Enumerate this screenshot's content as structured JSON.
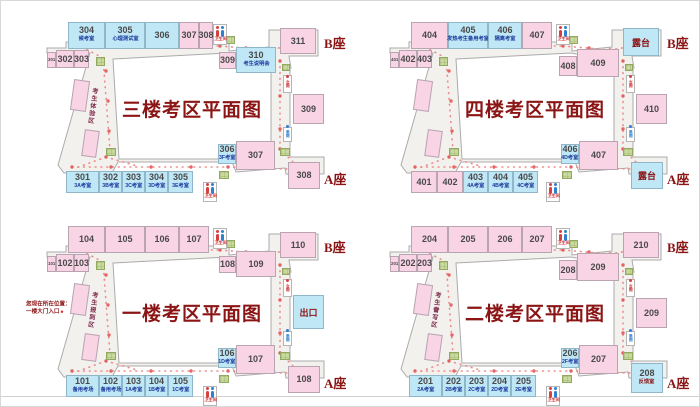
{
  "labels": {
    "building_b": "B座",
    "building_a": "A座",
    "restroom": "卫生间",
    "wc_female": "女厕",
    "wc_male": "男厕"
  },
  "colors": {
    "title": "#8B1414",
    "pink_room": "#F8D4E4",
    "blue_room": "#BFE7F6",
    "path_dots": "#ED8C8C",
    "stairs_green": "#C9DA9F",
    "sublabel_navy": "#1B3A9E"
  },
  "floors": [
    {
      "id": "floor-3",
      "title": "三楼考区平面图",
      "corridor_text": "考生体验区",
      "offset": [
        5,
        0
      ],
      "rooms": [
        {
          "n": "304",
          "sub": "候考室",
          "t": "blue",
          "x": 62,
          "y": 21,
          "w": 37,
          "h": 27
        },
        {
          "n": "305",
          "sub": "心理测试室",
          "t": "blue",
          "x": 99,
          "y": 21,
          "w": 40,
          "h": 27
        },
        {
          "n": "306",
          "t": "blue",
          "x": 139,
          "y": 21,
          "w": 34,
          "h": 27
        },
        {
          "n": "307",
          "t": "pink",
          "x": 173,
          "y": 21,
          "w": 20,
          "h": 27
        },
        {
          "n": "308",
          "t": "pink",
          "x": 193,
          "y": 21,
          "w": 14,
          "h": 27
        },
        {
          "n": "301",
          "t": "tiny",
          "x": 41,
          "y": 51,
          "w": 9,
          "h": 16
        },
        {
          "n": "302",
          "t": "pink",
          "x": 50,
          "y": 49,
          "w": 18,
          "h": 18
        },
        {
          "n": "303",
          "t": "pink",
          "x": 68,
          "y": 49,
          "w": 15,
          "h": 18
        },
        {
          "t": "diag",
          "x": 66,
          "y": 79,
          "w": 16,
          "h": 31
        },
        {
          "t": "diag",
          "x": 77,
          "y": 129,
          "w": 15,
          "h": 27
        },
        {
          "n": "309",
          "t": "pink",
          "x": 213,
          "y": 51,
          "w": 17,
          "h": 17
        },
        {
          "n": "310",
          "sub": "考生说明会",
          "t": "blue",
          "x": 230,
          "y": 46,
          "w": 40,
          "h": 26
        },
        {
          "n": "311",
          "t": "pink",
          "x": 274,
          "y": 27,
          "w": 36,
          "h": 26
        },
        {
          "n": "309",
          "t": "pink",
          "x": 287,
          "y": 93,
          "w": 31,
          "h": 30
        },
        {
          "n": "306",
          "sub": "3F考室",
          "t": "blue",
          "x": 212,
          "y": 143,
          "w": 18,
          "h": 20
        },
        {
          "n": "307",
          "t": "pink",
          "x": 230,
          "y": 140,
          "w": 39,
          "h": 29
        },
        {
          "n": "308",
          "t": "pink",
          "x": 282,
          "y": 161,
          "w": 32,
          "h": 27
        },
        {
          "n": "301",
          "sub": "3A考室",
          "t": "blue",
          "x": 60,
          "y": 170,
          "w": 33,
          "h": 22
        },
        {
          "n": "302",
          "sub": "3B考室",
          "t": "blue",
          "x": 93,
          "y": 170,
          "w": 23,
          "h": 22
        },
        {
          "n": "303",
          "sub": "3C考室",
          "t": "blue",
          "x": 116,
          "y": 170,
          "w": 23,
          "h": 22
        },
        {
          "n": "304",
          "sub": "3D考室",
          "t": "blue",
          "x": 139,
          "y": 170,
          "w": 23,
          "h": 22
        },
        {
          "n": "305",
          "sub": "3E考室",
          "t": "blue",
          "x": 162,
          "y": 170,
          "w": 25,
          "h": 22
        }
      ]
    },
    {
      "id": "floor-4",
      "title": "四楼考区平面图",
      "corridor_text": "",
      "offset": [
        348,
        0
      ],
      "rooms": [
        {
          "n": "404",
          "t": "pink",
          "x": 62,
          "y": 21,
          "w": 37,
          "h": 27
        },
        {
          "n": "405",
          "sub": "发热考生备用考室",
          "t": "blue",
          "x": 99,
          "y": 21,
          "w": 40,
          "h": 27
        },
        {
          "n": "406",
          "sub": "隔离考室",
          "t": "blue",
          "x": 139,
          "y": 21,
          "w": 34,
          "h": 27
        },
        {
          "n": "407",
          "t": "pink",
          "x": 173,
          "y": 21,
          "w": 30,
          "h": 27
        },
        {
          "n": "401",
          "t": "tiny",
          "x": 41,
          "y": 51,
          "w": 9,
          "h": 16
        },
        {
          "n": "402",
          "t": "pink",
          "x": 50,
          "y": 49,
          "w": 18,
          "h": 18
        },
        {
          "n": "403",
          "t": "pink",
          "x": 68,
          "y": 49,
          "w": 15,
          "h": 18
        },
        {
          "t": "diag",
          "x": 66,
          "y": 79,
          "w": 16,
          "h": 31
        },
        {
          "t": "diag",
          "x": 77,
          "y": 129,
          "w": 15,
          "h": 27
        },
        {
          "n": "408",
          "t": "pink",
          "x": 210,
          "y": 55,
          "w": 18,
          "h": 20
        },
        {
          "n": "409",
          "t": "pink",
          "x": 228,
          "y": 48,
          "w": 42,
          "h": 28
        },
        {
          "lab": "露台",
          "t": "terrace",
          "x": 274,
          "y": 27,
          "w": 36,
          "h": 28
        },
        {
          "n": "410",
          "t": "pink",
          "x": 287,
          "y": 93,
          "w": 31,
          "h": 30
        },
        {
          "n": "406",
          "sub": "4D考室",
          "t": "blue",
          "x": 212,
          "y": 143,
          "w": 18,
          "h": 20
        },
        {
          "n": "407",
          "t": "pink",
          "x": 230,
          "y": 140,
          "w": 39,
          "h": 29
        },
        {
          "lab": "露台",
          "t": "terrace",
          "x": 282,
          "y": 161,
          "w": 32,
          "h": 27
        },
        {
          "n": "401",
          "t": "pink",
          "x": 62,
          "y": 170,
          "w": 26,
          "h": 22
        },
        {
          "n": "402",
          "t": "pink",
          "x": 88,
          "y": 170,
          "w": 26,
          "h": 22
        },
        {
          "n": "403",
          "sub": "4A考室",
          "t": "blue",
          "x": 114,
          "y": 170,
          "w": 25,
          "h": 22
        },
        {
          "n": "404",
          "sub": "4B考室",
          "t": "blue",
          "x": 139,
          "y": 170,
          "w": 25,
          "h": 22
        },
        {
          "n": "405",
          "sub": "4C考室",
          "t": "blue",
          "x": 164,
          "y": 170,
          "w": 25,
          "h": 22
        }
      ]
    },
    {
      "id": "floor-1",
      "title": "一楼考区平面图",
      "corridor_text": "考生报到区",
      "offset": [
        5,
        204
      ],
      "annotation": {
        "lines": [
          "您现在所在位置：",
          "一楼大门入口"
        ],
        "x": 20,
        "y": 95
      },
      "rooms": [
        {
          "n": "104",
          "t": "pink",
          "x": 62,
          "y": 21,
          "w": 37,
          "h": 27
        },
        {
          "n": "105",
          "t": "pink",
          "x": 99,
          "y": 21,
          "w": 40,
          "h": 27
        },
        {
          "n": "106",
          "t": "pink",
          "x": 139,
          "y": 21,
          "w": 34,
          "h": 27
        },
        {
          "n": "107",
          "t": "pink",
          "x": 173,
          "y": 21,
          "w": 30,
          "h": 27
        },
        {
          "n": "101",
          "t": "tiny",
          "x": 41,
          "y": 51,
          "w": 9,
          "h": 16
        },
        {
          "n": "102",
          "t": "pink",
          "x": 50,
          "y": 49,
          "w": 18,
          "h": 18
        },
        {
          "n": "103",
          "t": "pink",
          "x": 68,
          "y": 49,
          "w": 15,
          "h": 18
        },
        {
          "t": "diag",
          "x": 66,
          "y": 79,
          "w": 16,
          "h": 31
        },
        {
          "t": "diag",
          "x": 77,
          "y": 129,
          "w": 15,
          "h": 27
        },
        {
          "n": "108",
          "t": "pink",
          "x": 213,
          "y": 51,
          "w": 17,
          "h": 17
        },
        {
          "n": "109",
          "t": "pink",
          "x": 230,
          "y": 46,
          "w": 40,
          "h": 26
        },
        {
          "n": "110",
          "t": "pink",
          "x": 274,
          "y": 27,
          "w": 36,
          "h": 26
        },
        {
          "lab": "出口",
          "t": "terrace",
          "x": 287,
          "y": 90,
          "w": 31,
          "h": 34
        },
        {
          "n": "106",
          "sub": "1D考室",
          "t": "blue",
          "x": 212,
          "y": 143,
          "w": 18,
          "h": 20
        },
        {
          "n": "107",
          "t": "pink",
          "x": 230,
          "y": 140,
          "w": 39,
          "h": 29
        },
        {
          "n": "108",
          "t": "pink",
          "x": 282,
          "y": 161,
          "w": 32,
          "h": 27
        },
        {
          "n": "101",
          "sub": "备用考场",
          "t": "blue",
          "x": 60,
          "y": 170,
          "w": 33,
          "h": 22
        },
        {
          "n": "102",
          "sub": "备用考场",
          "t": "blue",
          "x": 93,
          "y": 170,
          "w": 23,
          "h": 22
        },
        {
          "n": "103",
          "sub": "1A考室",
          "t": "blue",
          "x": 116,
          "y": 170,
          "w": 23,
          "h": 22
        },
        {
          "n": "104",
          "sub": "1B考室",
          "t": "blue",
          "x": 139,
          "y": 170,
          "w": 23,
          "h": 22
        },
        {
          "n": "105",
          "sub": "1C考室",
          "t": "blue",
          "x": 162,
          "y": 170,
          "w": 25,
          "h": 22
        }
      ]
    },
    {
      "id": "floor-2",
      "title": "二楼考区平面图",
      "corridor_text": "考生誊写区",
      "offset": [
        348,
        204
      ],
      "rooms": [
        {
          "n": "204",
          "t": "pink",
          "x": 62,
          "y": 21,
          "w": 37,
          "h": 27
        },
        {
          "n": "205",
          "t": "pink",
          "x": 99,
          "y": 21,
          "w": 40,
          "h": 27
        },
        {
          "n": "206",
          "t": "pink",
          "x": 139,
          "y": 21,
          "w": 34,
          "h": 27
        },
        {
          "n": "207",
          "t": "pink",
          "x": 173,
          "y": 21,
          "w": 30,
          "h": 27
        },
        {
          "n": "201",
          "t": "tiny",
          "x": 41,
          "y": 51,
          "w": 9,
          "h": 16
        },
        {
          "n": "202",
          "t": "pink",
          "x": 50,
          "y": 49,
          "w": 18,
          "h": 18
        },
        {
          "n": "203",
          "t": "pink",
          "x": 68,
          "y": 49,
          "w": 15,
          "h": 18
        },
        {
          "t": "diag",
          "x": 66,
          "y": 79,
          "w": 16,
          "h": 31
        },
        {
          "t": "diag",
          "x": 77,
          "y": 129,
          "w": 15,
          "h": 27
        },
        {
          "n": "208",
          "t": "pink",
          "x": 210,
          "y": 55,
          "w": 18,
          "h": 20
        },
        {
          "n": "209",
          "t": "pink",
          "x": 228,
          "y": 48,
          "w": 42,
          "h": 28
        },
        {
          "n": "210",
          "t": "pink",
          "x": 274,
          "y": 27,
          "w": 36,
          "h": 26
        },
        {
          "n": "209",
          "t": "pink",
          "x": 287,
          "y": 93,
          "w": 31,
          "h": 30
        },
        {
          "n": "206",
          "sub": "2F考室",
          "t": "blue",
          "x": 212,
          "y": 143,
          "w": 18,
          "h": 20
        },
        {
          "n": "207",
          "t": "pink",
          "x": 230,
          "y": 140,
          "w": 39,
          "h": 29
        },
        {
          "n": "208",
          "sub": "反馈室",
          "subred": true,
          "t": "blue",
          "x": 282,
          "y": 158,
          "w": 32,
          "h": 30
        },
        {
          "n": "201",
          "sub": "2A考室",
          "t": "blue",
          "x": 60,
          "y": 170,
          "w": 33,
          "h": 22
        },
        {
          "n": "202",
          "sub": "2B考室",
          "t": "blue",
          "x": 93,
          "y": 170,
          "w": 23,
          "h": 22
        },
        {
          "n": "203",
          "sub": "2C考室",
          "t": "blue",
          "x": 116,
          "y": 170,
          "w": 23,
          "h": 22
        },
        {
          "n": "204",
          "sub": "2D考室",
          "t": "blue",
          "x": 139,
          "y": 170,
          "w": 23,
          "h": 22
        },
        {
          "n": "205",
          "sub": "2E考室",
          "t": "blue",
          "x": 162,
          "y": 170,
          "w": 25,
          "h": 22
        }
      ]
    }
  ]
}
